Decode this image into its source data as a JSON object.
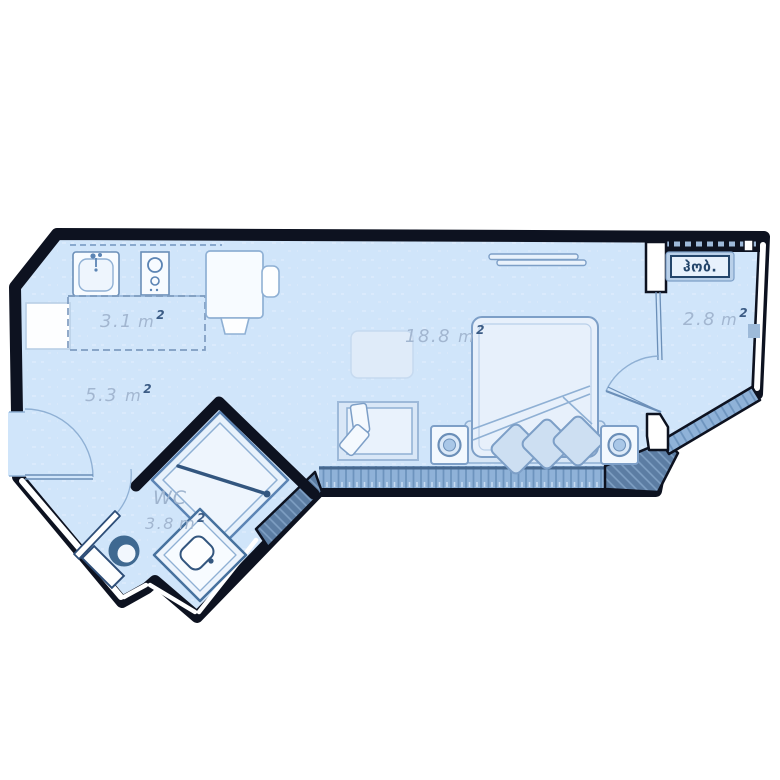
{
  "plan": {
    "title": "studio-apartment-floor-plan",
    "rooms": [
      {
        "id": "kitchen-zone",
        "area_value": "3.1",
        "area_unit": "m",
        "area_sup": "2"
      },
      {
        "id": "hallway",
        "area_value": "5.3",
        "area_unit": "m",
        "area_sup": "2"
      },
      {
        "id": "living-room",
        "area_value": "18.8",
        "area_unit": "m",
        "area_sup": "2"
      },
      {
        "id": "balcony",
        "name": "ჰობ.",
        "area_value": "2.8",
        "area_unit": "m",
        "area_sup": "2"
      },
      {
        "id": "bathroom",
        "name": "WC",
        "area_value": "3.8",
        "area_unit": "m",
        "area_sup": "2"
      }
    ],
    "fixtures": [
      "kitchen-sink",
      "cooktop",
      "fridge",
      "desk",
      "desk-chair",
      "stool",
      "ceiling-light",
      "rug-table",
      "sofa",
      "bed",
      "pillows",
      "nightstand-left",
      "nightstand-right",
      "shower",
      "washbasin",
      "toilet",
      "entry-door",
      "balcony-door",
      "wc-door",
      "window-band-south",
      "window-band-diagonal",
      "window-band-north"
    ],
    "colors": {
      "floor": "#d0e5fa",
      "floor_texture": "#deecfc",
      "wall": "#0d1220",
      "wall_white_fill": "#ffffff",
      "furniture_stroke": "#7d9fc7",
      "furniture_stroke_dark": "#5b84b4",
      "furniture_fill": "#eef5fd",
      "accent_navy": "#33567f",
      "toilet_bowl": "#3f6991",
      "window_band": "#8fb2d8",
      "window_tick": "#6d94be",
      "shadow_band": "#5c7da3",
      "label_text": "#a2b6d0",
      "label_sup": "#3c5c85",
      "georgian_label_text": "#24466b",
      "georgian_label_bg": "#e7f1fc",
      "georgian_label_frame": "#b9d0e9"
    }
  }
}
